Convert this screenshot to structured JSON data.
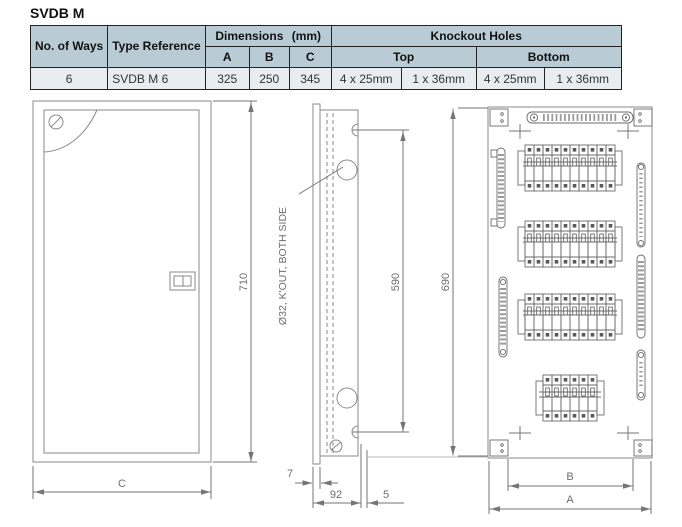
{
  "page": {
    "title": "SVDB M"
  },
  "spec_table": {
    "headers": {
      "no_of_ways": "No. of Ways",
      "type_reference": "Type Reference",
      "dimensions_mm": "Dimensions (mm)",
      "dim_a": "A",
      "dim_b": "B",
      "dim_c": "C",
      "knockout_holes": "Knockout Holes",
      "top": "Top",
      "bottom": "Bottom"
    },
    "row": {
      "ways": "6",
      "type": "SVDB M 6",
      "a": "325",
      "b": "250",
      "c": "345",
      "knockout_top_1": "4 x 25mm",
      "knockout_top_2": "1 x 36mm",
      "knockout_bottom_1": "4 x 25mm",
      "knockout_bottom_2": "1 x 36mm"
    },
    "colors": {
      "header_bg": "#b9ccd6",
      "row_bg": "#e9edf0",
      "border": "#222222"
    }
  },
  "drawings": {
    "line_color": "#8a8a8a",
    "dim_color": "#757575",
    "front_view": {
      "height": "710",
      "width": "C"
    },
    "side_view": {
      "knockout_note": "Ø32, K'OUT, BOTH SIDE",
      "hole_spacing": "590",
      "overall_height": "690",
      "flange_depth": "7",
      "body_depth": "92",
      "rear_offset": "5"
    },
    "internal_view": {
      "fixing_width": "B",
      "overall_width": "A"
    }
  }
}
